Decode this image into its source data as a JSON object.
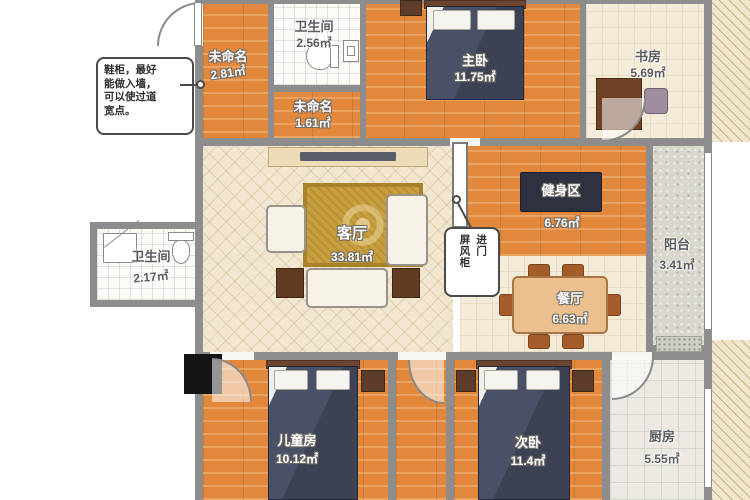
{
  "plan": {
    "type": "apartment-floor-plan",
    "unit": "㎡"
  },
  "rooms": {
    "foyer": {
      "label": "未命名",
      "area": "2.81㎡"
    },
    "bath_top": {
      "label": "卫生间",
      "area": "2.56㎡"
    },
    "hall": {
      "label": "未命名",
      "area": "1.61㎡"
    },
    "master": {
      "label": "主卧",
      "area": "11.75㎡"
    },
    "study": {
      "label": "书房",
      "area": "5.69㎡"
    },
    "balcony": {
      "label": "阳台",
      "area": "3.41㎡"
    },
    "gym": {
      "label": "健身区",
      "area": "6.76㎡"
    },
    "living": {
      "label": "客厅",
      "area": "33.81㎡"
    },
    "dining": {
      "label": "餐厅",
      "area": "6.63㎡"
    },
    "bath_left": {
      "label": "卫生间",
      "area": "2.17㎡"
    },
    "kids": {
      "label": "儿童房",
      "area": "10.12㎡"
    },
    "second": {
      "label": "次卧",
      "area": "11.4㎡"
    },
    "kitchen": {
      "label": "厨房",
      "area": "5.55㎡"
    }
  },
  "annotations": {
    "shoe_note_lines": [
      "鞋柜，最好",
      "能做入墙，",
      "可以使过道",
      "宽点。"
    ],
    "screen_note_col_right": "进门",
    "screen_note_col_left": "屏风柜"
  },
  "colors": {
    "wood_floor": "#e1883c",
    "light_floor": "#f1e6cf",
    "wall": "#8d8d8d",
    "bed_dark": "#3c4154",
    "rug_gold": "#c79f3e",
    "gym_mat": "#2d3140",
    "furniture_brown": "#5d3d2a"
  }
}
